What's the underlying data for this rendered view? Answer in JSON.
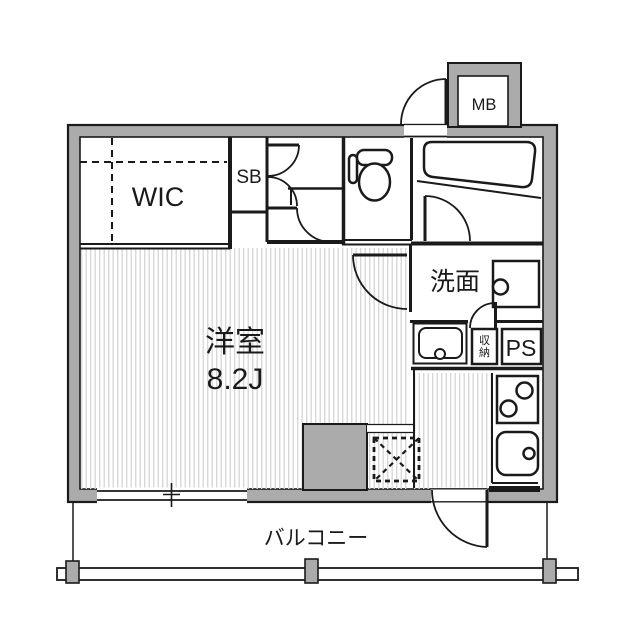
{
  "meta": {
    "kind": "apartment-floorplan"
  },
  "colors": {
    "wall_gray": "#ABABAB",
    "line": "#1A1A1A",
    "stripe": "#D8D8D8",
    "background": "#FFFFFF"
  },
  "rooms": {
    "wic_label": "WIC",
    "shoe_box_label": "SB",
    "meter_box_label": "MB",
    "washroom_label": "洗面",
    "main_room_name": "洋室",
    "main_room_size": "8.2J",
    "storage_label": "収納",
    "storage_chars": [
      "収",
      "納"
    ],
    "pipe_space_label": "PS",
    "balcony_label": "バルコニー"
  },
  "icons": {
    "toilet": "toilet-icon",
    "bathtub": "bathtub-icon",
    "washbasin": "washbasin-icon",
    "washing_machine": "washing-machine-pan-icon",
    "stove": "stove-burners-icon",
    "kitchen_sink": "kitchen-sink-icon",
    "refrigerator_space": "refrigerator-space-icon"
  }
}
